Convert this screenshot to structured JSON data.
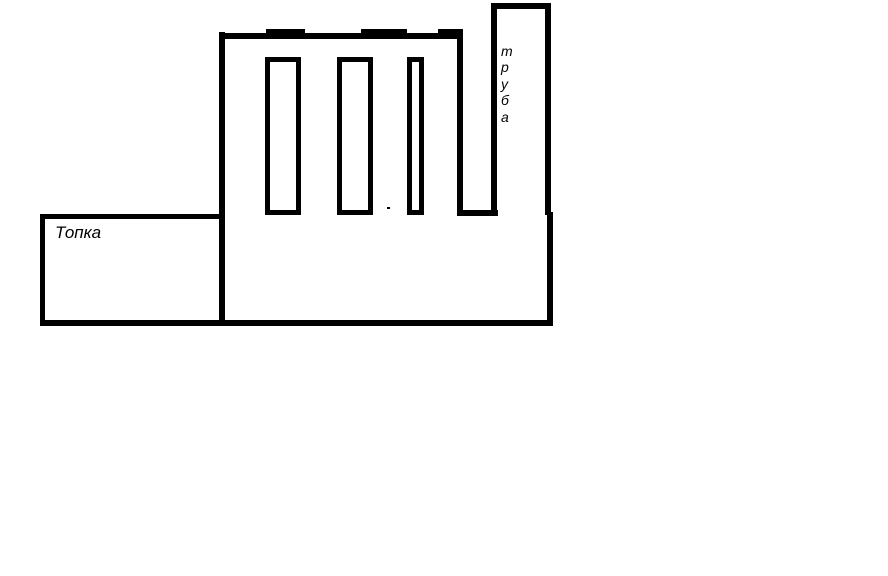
{
  "canvas": {
    "background": "#ffffff",
    "stroke": "#000000"
  },
  "labels": {
    "firebox": "Топка",
    "chimney": "труба"
  }
}
